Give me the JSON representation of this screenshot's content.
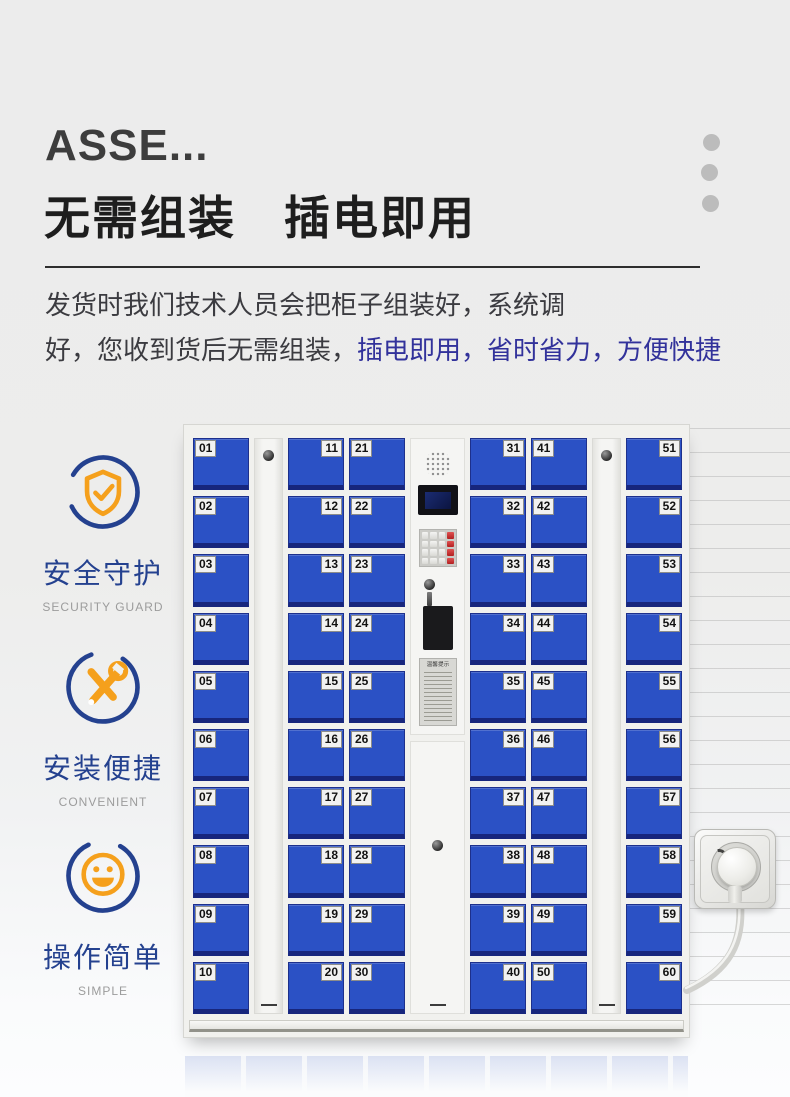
{
  "header": {
    "title": "ASSE...",
    "heading": "无需组装　插电即用",
    "paragraph": {
      "line1": "发货时我们技术人员会把柜子组装好，系统调",
      "line2_black": "好，您收到货后无需组装，",
      "line2_accent": "插电即用，省时省力，方便快捷"
    }
  },
  "features": [
    {
      "label": "安全守护",
      "sublabel": "SECURITY GUARD",
      "icon": "shield-check-icon"
    },
    {
      "label": "安装便捷",
      "sublabel": "CONVENIENT",
      "icon": "tools-icon"
    },
    {
      "label": "操作简单",
      "sublabel": "SIMPLE",
      "icon": "smiley-icon"
    }
  ],
  "cabinet": {
    "panel": {
      "sticker_title": "温馨提示"
    },
    "columns": [
      {
        "type": "lockers",
        "label_side": "left",
        "numbers": [
          "01",
          "02",
          "03",
          "04",
          "05",
          "06",
          "07",
          "08",
          "09",
          "10"
        ]
      },
      {
        "type": "hinge"
      },
      {
        "type": "lockers",
        "label_side": "right",
        "numbers": [
          "11",
          "12",
          "13",
          "14",
          "15",
          "16",
          "17",
          "18",
          "19",
          "20"
        ]
      },
      {
        "type": "lockers",
        "label_side": "left",
        "numbers": [
          "21",
          "22",
          "23",
          "24",
          "25",
          "26",
          "27",
          "28",
          "29",
          "30"
        ]
      },
      {
        "type": "control-panel"
      },
      {
        "type": "lockers",
        "label_side": "right",
        "numbers": [
          "31",
          "32",
          "33",
          "34",
          "35",
          "36",
          "37",
          "38",
          "39",
          "40"
        ]
      },
      {
        "type": "lockers",
        "label_side": "left",
        "numbers": [
          "41",
          "42",
          "43",
          "44",
          "45",
          "46",
          "47",
          "48",
          "49",
          "50"
        ]
      },
      {
        "type": "hinge"
      },
      {
        "type": "lockers",
        "label_side": "right",
        "numbers": [
          "51",
          "52",
          "53",
          "54",
          "55",
          "56",
          "57",
          "58",
          "59",
          "60"
        ]
      }
    ]
  },
  "colors": {
    "accent_text": "#32329b",
    "door_blue": "#2b51c5",
    "icon_orange": "#f5a01c",
    "icon_blue": "#24418f"
  }
}
